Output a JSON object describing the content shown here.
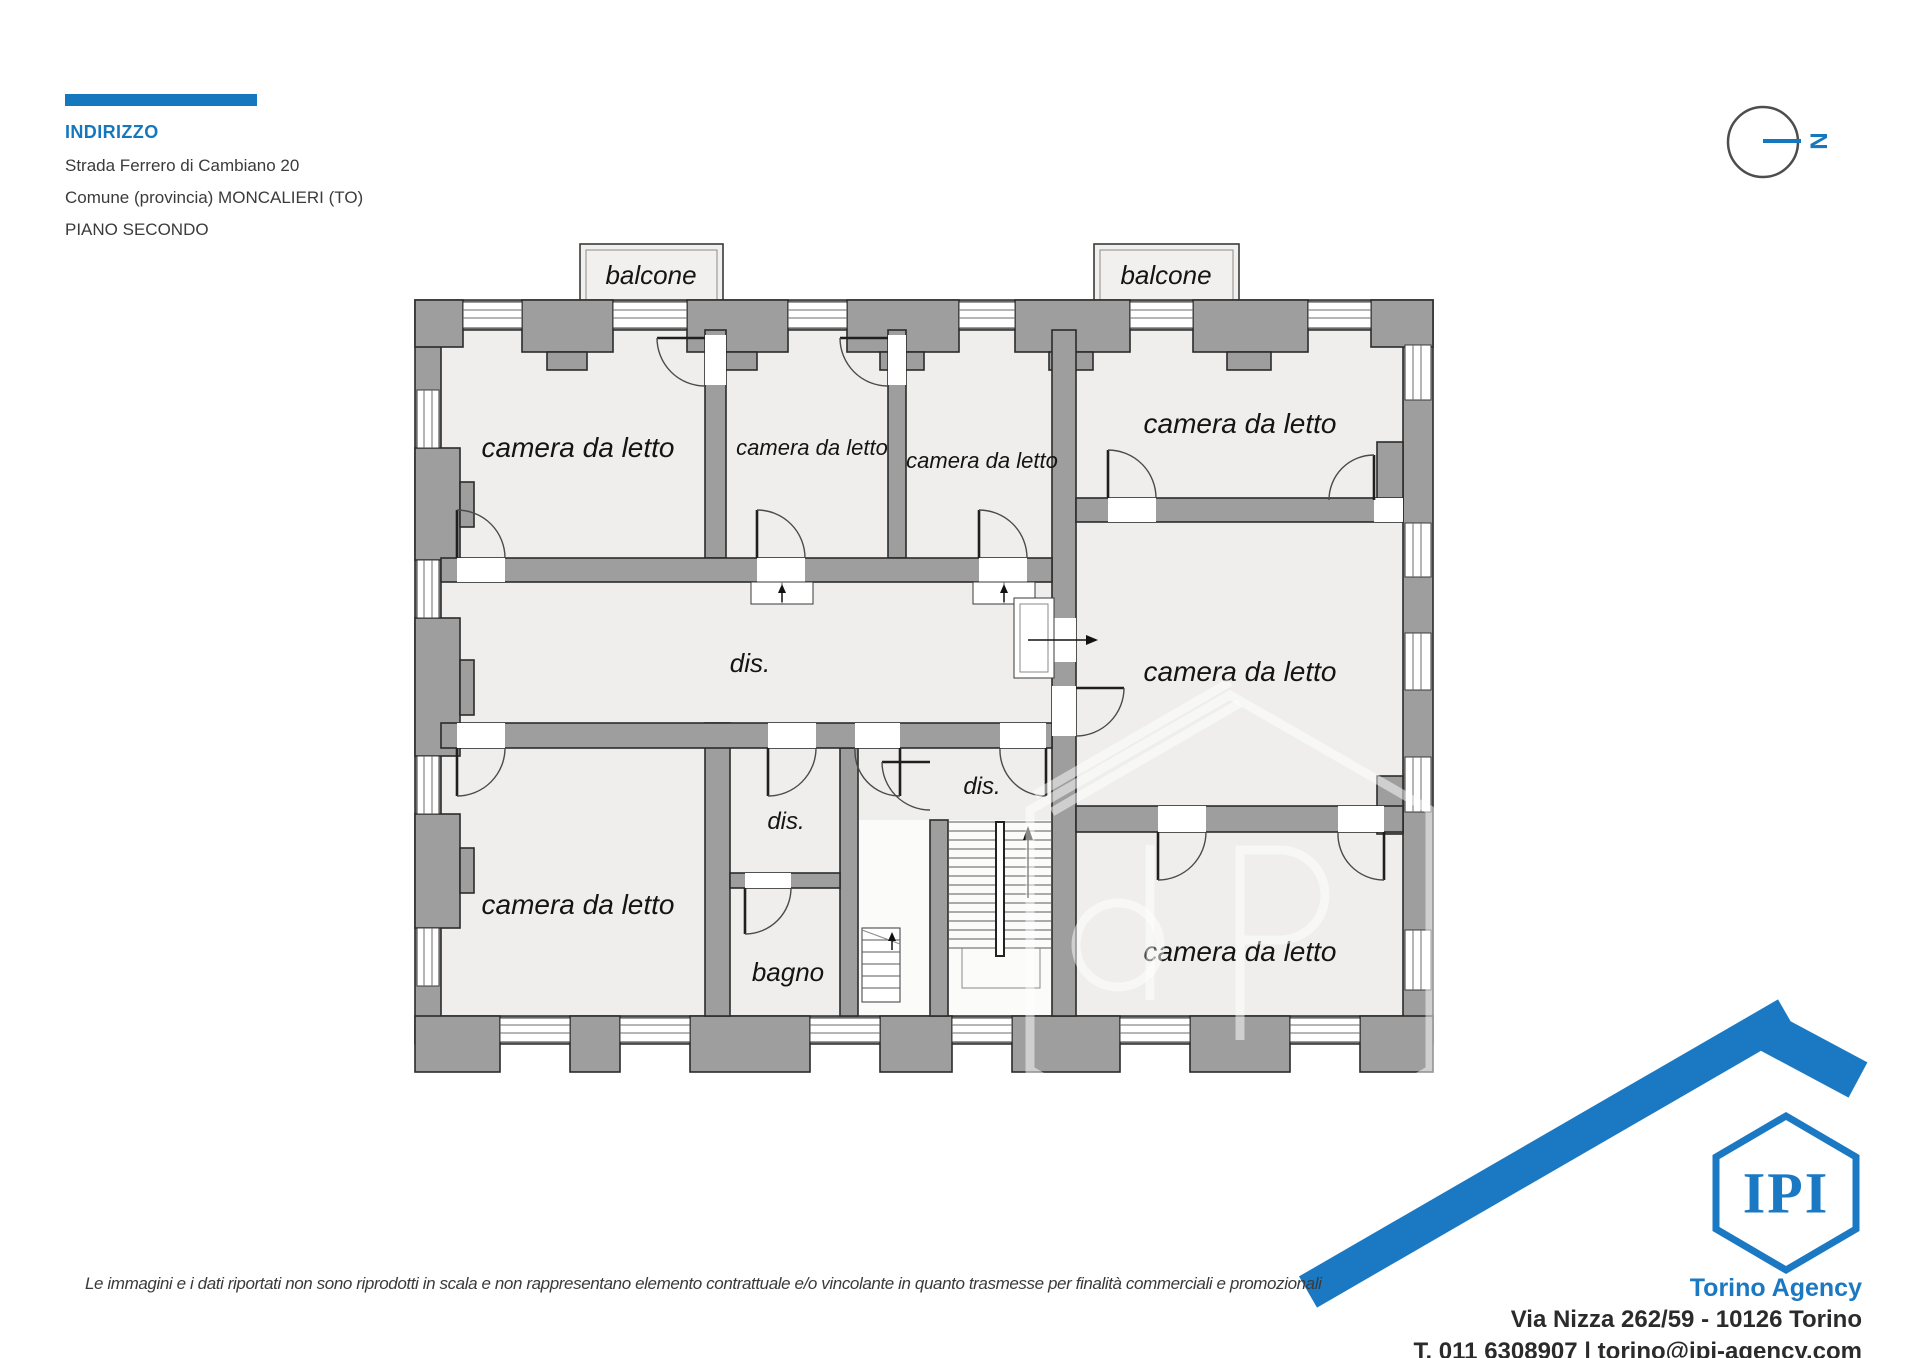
{
  "header": {
    "title": "INDIRIZZO",
    "address_line": "Strada Ferrero di Cambiano 20",
    "municipality_line": "Comune (provincia) MONCALIERI (TO)",
    "floor_line": "PIANO SECONDO"
  },
  "compass": {
    "north_label": "N"
  },
  "plan": {
    "balcony_labels": [
      {
        "label": "balcone"
      },
      {
        "label": "balcone"
      }
    ],
    "room_labels": [
      {
        "id": "bedroom-top-left",
        "label": "camera da letto"
      },
      {
        "id": "bedroom-top-mid-left",
        "label": "camera da letto"
      },
      {
        "id": "bedroom-top-mid-right",
        "label": "camera da letto"
      },
      {
        "id": "bedroom-top-right",
        "label": "camera da letto"
      },
      {
        "id": "bedroom-mid-right",
        "label": "camera da letto"
      },
      {
        "id": "bedroom-bottom-right",
        "label": "camera da letto"
      },
      {
        "id": "bedroom-bottom-left",
        "label": "camera da letto"
      }
    ],
    "hall_labels": [
      {
        "id": "hallway-main",
        "label": "dis."
      },
      {
        "id": "hallway-small",
        "label": "dis."
      },
      {
        "id": "hallway-right",
        "label": "dis."
      }
    ],
    "bathroom_label": "bagno"
  },
  "agency": {
    "logo_text": "IPI",
    "name": "Torino Agency",
    "address": "Via Nizza 262/59 - 10126 Torino",
    "contacts": "T. 011 6308907 | torino@ipi-agency.com"
  },
  "footer": {
    "disclaimer": "Le immagini e i dati riportati non sono riprodotti in scala e non rappresentano elemento contrattuale e/o vincolante in quanto trasmesse per finalità commerciali e promozionali"
  },
  "colors": {
    "accent_blue": "#1577BE",
    "logo_blue": "#1B79C4",
    "wall_gray": "#9E9E9E",
    "room_fill": "#EFEEEC"
  }
}
